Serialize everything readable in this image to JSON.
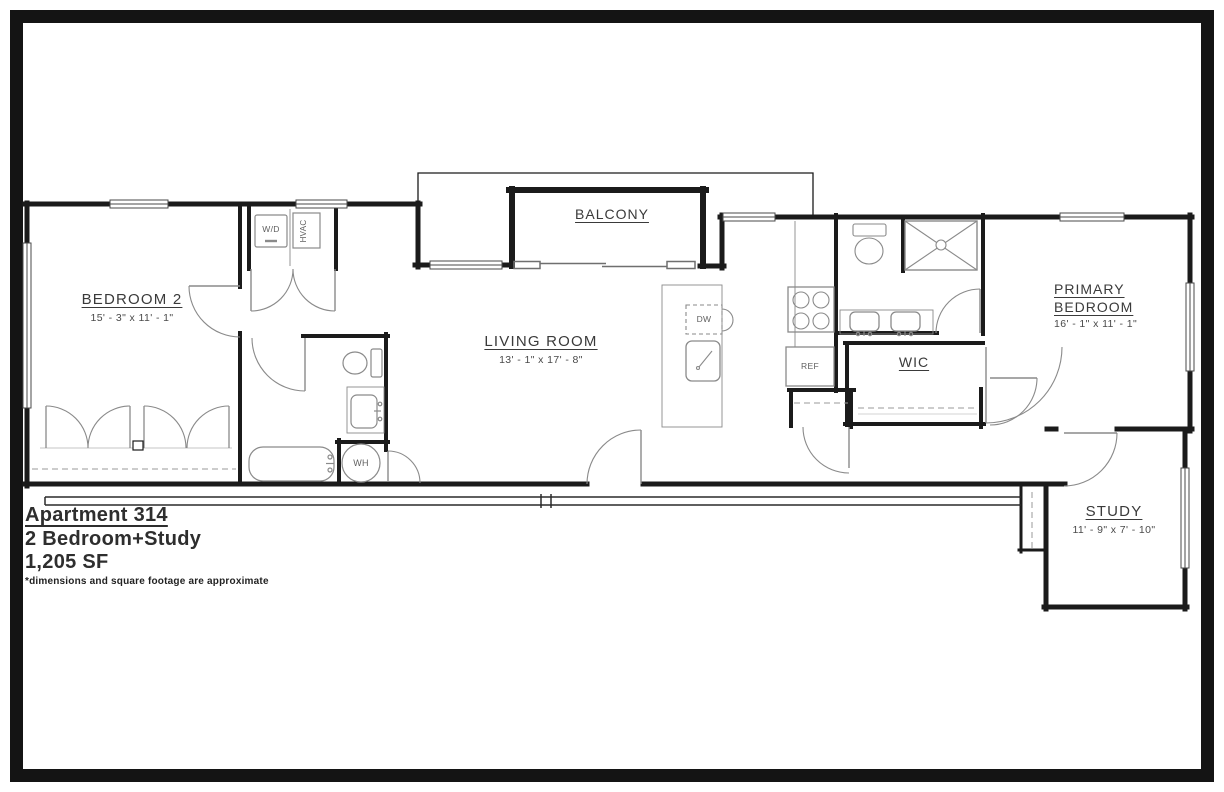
{
  "title_block": {
    "apartment": "Apartment 314",
    "unit_type": "2 Bedroom+Study",
    "area": "1,205 SF",
    "disclaimer": "*dimensions and square footage are approximate"
  },
  "rooms": {
    "bedroom2": {
      "name": "BEDROOM 2",
      "dims": "15' - 3\" x 11' - 1\""
    },
    "living": {
      "name": "LIVING ROOM",
      "dims": "13' - 1\" x 17' - 8\""
    },
    "balcony": {
      "name": "BALCONY"
    },
    "primary": {
      "name_line1": "PRIMARY",
      "name_line2": "BEDROOM",
      "dims": "16' - 1\" x 11' - 1\""
    },
    "wic": {
      "name": "WIC"
    },
    "study": {
      "name": "STUDY",
      "dims": "11' - 9\" x 7' - 10\""
    }
  },
  "fixtures": {
    "washer_dryer": "W/D",
    "hvac": "HVAC",
    "dishwasher": "DW",
    "refrigerator": "REF",
    "water_heater": "WH"
  },
  "colors": {
    "wall": "#1b1b1b",
    "fixture_line": "#8a8a8a",
    "text": "#3a3a3a"
  }
}
